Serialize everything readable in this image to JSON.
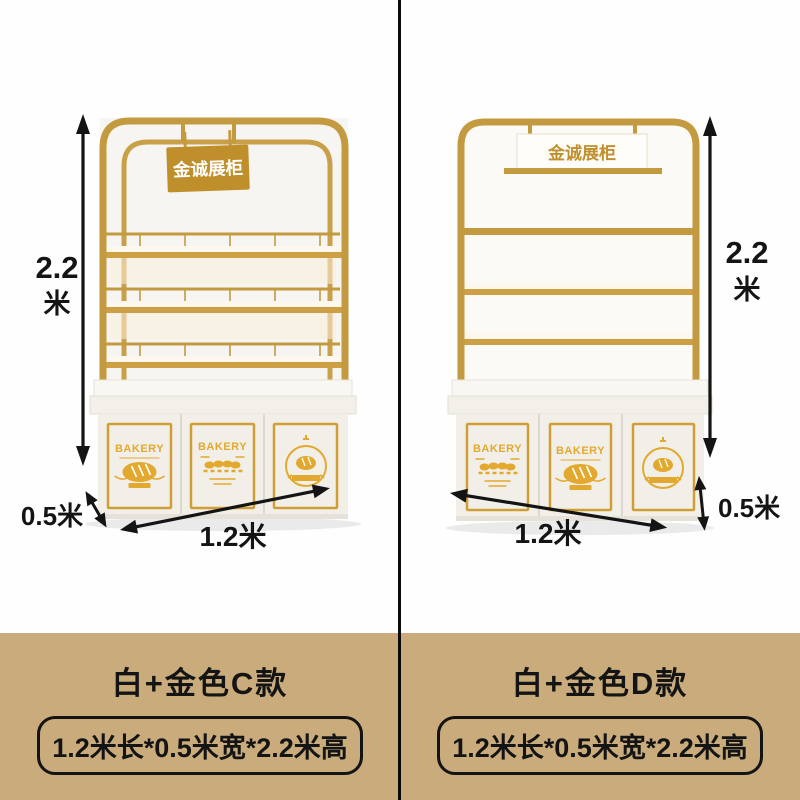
{
  "canvas": {
    "width": 800,
    "height": 800
  },
  "colors": {
    "photo_background": "#fefefe",
    "caption_band": "#c9ab7c",
    "divider": "#0a0a0a",
    "frame_gold": "#c49a40",
    "sign_gold": "#bf8f2c",
    "logo_gold": "#e3a92e",
    "door_frame_gold": "#cf9f35",
    "cabinet_white": "#f2efe9",
    "dimension_text": "#141414"
  },
  "products": [
    {
      "style_title": "白+金色C款",
      "spec": "1.2米长*0.5米宽*2.2米高",
      "sign_text": "金诚展柜",
      "dimensions": {
        "height_value": "2.2",
        "height_unit": "米",
        "depth_label": "0.5米",
        "width_label": "1.2米"
      },
      "doors": [
        {
          "type": "bread-loaf-logo",
          "label": "BAKERY"
        },
        {
          "type": "buns-row-logo",
          "label": "BAKERY"
        },
        {
          "type": "round-badge-logo"
        }
      ]
    },
    {
      "style_title": "白+金色D款",
      "spec": "1.2米长*0.5米宽*2.2米高",
      "sign_text": "金诚展柜",
      "dimensions": {
        "height_value": "2.2",
        "height_unit": "米",
        "depth_label": "0.5米",
        "width_label": "1.2米"
      },
      "doors": [
        {
          "type": "buns-row-logo",
          "label": "BAKERY"
        },
        {
          "type": "bread-loaf-logo",
          "label": "BAKERY"
        },
        {
          "type": "round-badge-logo"
        }
      ]
    }
  ]
}
